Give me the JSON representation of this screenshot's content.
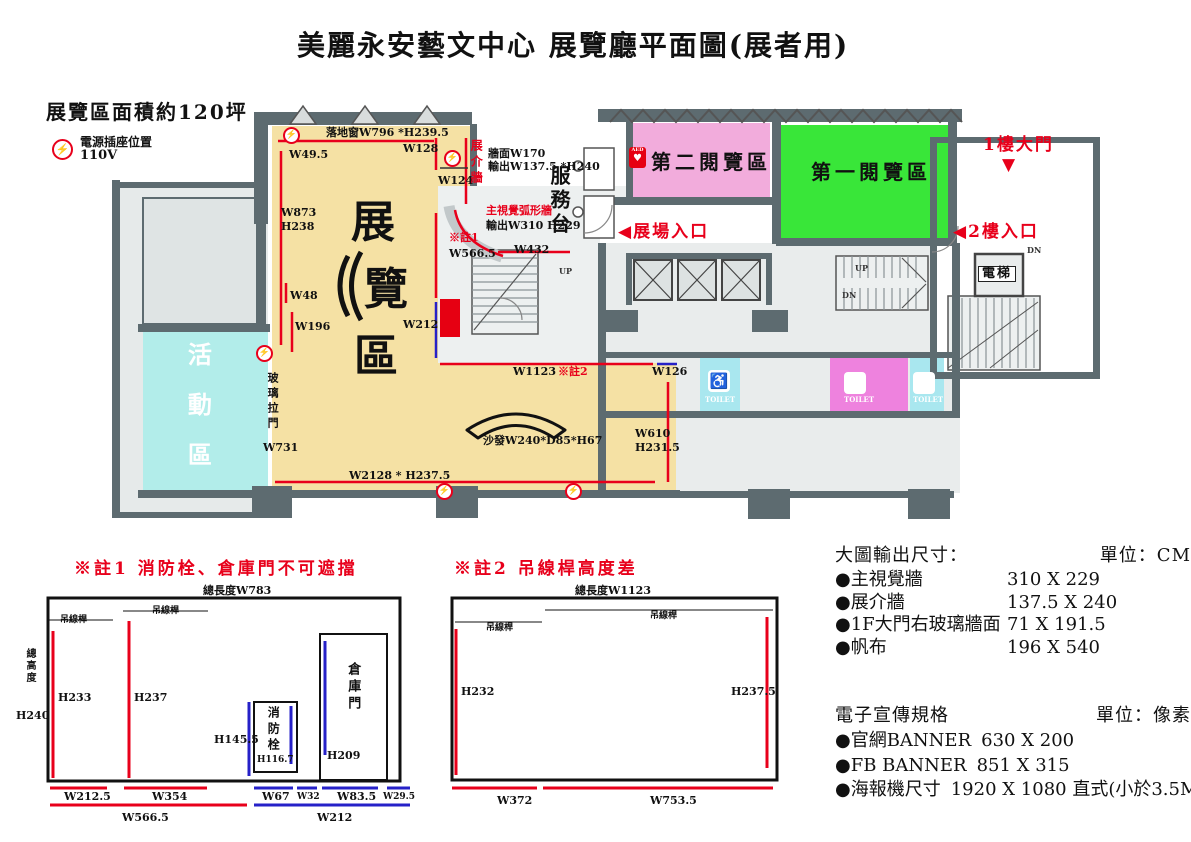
{
  "title": "美麗永安藝文中心 展覽廳平面圖(展者用)",
  "legend": {
    "area": "展覽區面積約120坪",
    "power_label": "電源插座位置",
    "power_voltage": "110V",
    "power_glyph": "⚡"
  },
  "icons": {
    "wheelchair": "♿",
    "aed_text": "AED",
    "aed_heart": "♥"
  },
  "colors": {
    "exhibition": "#F5E1A4",
    "activity": "#B2EDEA",
    "reading1": "#39E639",
    "reading2": "#F2ACDC",
    "toilet_cyan": "#A9E7EF",
    "toilet_pink": "#EE82DE",
    "wall": "#5D6B70",
    "annotation_red": "#E8001B",
    "annotation_blue": "#2621C8"
  },
  "power_icon_positions": [
    [
      283,
      127
    ],
    [
      444,
      150
    ],
    [
      256,
      345
    ],
    [
      436,
      483
    ],
    [
      565,
      483
    ]
  ],
  "labels": [
    {
      "n": "floor-window-measure",
      "t": "落地窗W796 *H239.5",
      "x": 326,
      "y": 127,
      "c": ""
    },
    {
      "n": "w49-5",
      "t": "W49.5",
      "x": 289,
      "y": 149,
      "c": ""
    },
    {
      "n": "w128",
      "t": "W128",
      "x": 403,
      "y": 143,
      "c": ""
    },
    {
      "n": "w124",
      "t": "W124",
      "x": 438,
      "y": 175,
      "c": ""
    },
    {
      "n": "w873",
      "t": "W873",
      "x": 281,
      "y": 207,
      "c": ""
    },
    {
      "n": "h238",
      "t": "H238",
      "x": 281,
      "y": 221,
      "c": ""
    },
    {
      "n": "note1-ref",
      "t": "※註1",
      "x": 449,
      "y": 232,
      "c": "red"
    },
    {
      "n": "w566-5",
      "t": "W566.5",
      "x": 449,
      "y": 248,
      "c": ""
    },
    {
      "n": "w48",
      "t": "W48",
      "x": 290,
      "y": 290,
      "c": ""
    },
    {
      "n": "w196",
      "t": "W196",
      "x": 295,
      "y": 321,
      "c": ""
    },
    {
      "n": "w212",
      "t": "W212",
      "x": 403,
      "y": 319,
      "c": ""
    },
    {
      "n": "wall-w170",
      "t": "牆面W170",
      "x": 488,
      "y": 148,
      "c": ""
    },
    {
      "n": "wall-output",
      "t": "輸出W137.5 *H240",
      "x": 488,
      "y": 161,
      "c": ""
    },
    {
      "n": "main-visual-wall",
      "t": "主視覺弧形牆",
      "x": 486,
      "y": 205,
      "c": "red"
    },
    {
      "n": "main-visual-output",
      "t": "輸出W310 H229",
      "x": 486,
      "y": 220,
      "c": ""
    },
    {
      "n": "w432",
      "t": "W432",
      "x": 514,
      "y": 244,
      "c": ""
    },
    {
      "n": "w1123",
      "t": "W1123",
      "x": 513,
      "y": 366,
      "c": ""
    },
    {
      "n": "note2-ref",
      "t": "※註2",
      "x": 558,
      "y": 366,
      "c": "red"
    },
    {
      "n": "w126",
      "t": "W126",
      "x": 652,
      "y": 366,
      "c": ""
    },
    {
      "n": "w610",
      "t": "W610",
      "x": 635,
      "y": 428,
      "c": ""
    },
    {
      "n": "h231-5",
      "t": "H231.5",
      "x": 635,
      "y": 442,
      "c": ""
    },
    {
      "n": "sofa-size",
      "t": "沙發W240*D85*H67",
      "x": 483,
      "y": 435,
      "c": ""
    },
    {
      "n": "w2128",
      "t": "W2128 * H237.5",
      "x": 349,
      "y": 470,
      "c": ""
    },
    {
      "n": "glass-door",
      "t": "玻璃拉門",
      "x": 266,
      "y": 372,
      "c": "vert"
    },
    {
      "n": "w731",
      "t": "W731",
      "x": 263,
      "y": 442,
      "c": ""
    },
    {
      "n": "exhibit-intro-wall",
      "t": "展介牆",
      "x": 469,
      "y": 139,
      "c": "vert red sm12"
    },
    {
      "n": "service-counter",
      "t": "服務台",
      "x": 548,
      "y": 165,
      "c": "vert room"
    },
    {
      "n": "reading-room-2",
      "t": "第二閱覽區",
      "x": 651,
      "y": 151,
      "c": "room"
    },
    {
      "n": "reading-room-1",
      "t": "第一閱覽區",
      "x": 811,
      "y": 161,
      "c": "room"
    },
    {
      "n": "exhibition-char-1",
      "t": "展",
      "x": 351,
      "y": 199,
      "c": "big"
    },
    {
      "n": "exhibition-char-2",
      "t": "覽",
      "x": 364,
      "y": 266,
      "c": "big"
    },
    {
      "n": "exhibition-char-3",
      "t": "區",
      "x": 354,
      "y": 333,
      "c": "big"
    },
    {
      "n": "activity-room",
      "t": "活動區",
      "x": 184,
      "y": 342,
      "c": "vert actv"
    },
    {
      "n": "entrance-1f",
      "t": "1樓大門",
      "x": 983,
      "y": 136,
      "c": "r16"
    },
    {
      "n": "entrance-1f-arrow",
      "t": "▼",
      "x": 1002,
      "y": 156,
      "c": "r16"
    },
    {
      "n": "entrance-2f",
      "t": "◀2樓入口",
      "x": 953,
      "y": 223,
      "c": "r16"
    },
    {
      "n": "hall-entrance",
      "t": "◀展場入口",
      "x": 618,
      "y": 223,
      "c": "r16"
    },
    {
      "n": "elevator-room",
      "t": "電梯",
      "x": 978,
      "y": 266,
      "c": "elev"
    },
    {
      "n": "up-1",
      "t": "UP",
      "x": 559,
      "y": 267,
      "c": "tiny"
    },
    {
      "n": "up-2",
      "t": "UP",
      "x": 855,
      "y": 264,
      "c": "tiny"
    },
    {
      "n": "dn-1",
      "t": "DN",
      "x": 842,
      "y": 291,
      "c": "tiny"
    },
    {
      "n": "dn-2",
      "t": "DN",
      "x": 1027,
      "y": 246,
      "c": "tiny"
    },
    {
      "n": "hydrant",
      "t": "消防栓",
      "x": 445,
      "y": 302,
      "c": "vert hyd"
    },
    {
      "n": "toilet-accessible-text",
      "t": "TOILET",
      "x": 705,
      "y": 396,
      "c": "toilet"
    },
    {
      "n": "toilet-women-text",
      "t": "TOILET",
      "x": 844,
      "y": 396,
      "c": "toilet"
    },
    {
      "n": "toilet-men-text",
      "t": "TOILET",
      "x": 913,
      "y": 396,
      "c": "toilet"
    },
    {
      "n": "note1-title",
      "t": "※註1 消防栓、倉庫門不可遮擋",
      "x": 74,
      "y": 560,
      "c": "note-title"
    },
    {
      "n": "note1-total-length",
      "t": "總長度W783",
      "x": 203,
      "y": 585,
      "c": ""
    },
    {
      "n": "note1-total-height",
      "t": "總高度",
      "x": 24,
      "y": 648,
      "c": "vert sm10"
    },
    {
      "n": "note1-h240",
      "t": "H240",
      "x": 16,
      "y": 710,
      "c": ""
    },
    {
      "n": "note1-bar-label-1",
      "t": "吊線桿",
      "x": 60,
      "y": 616,
      "c": "tinycjk"
    },
    {
      "n": "note1-bar-label-2",
      "t": "吊線桿",
      "x": 152,
      "y": 607,
      "c": "tinycjk"
    },
    {
      "n": "note1-h233",
      "t": "H233",
      "x": 58,
      "y": 692,
      "c": ""
    },
    {
      "n": "note1-h237",
      "t": "H237",
      "x": 134,
      "y": 692,
      "c": ""
    },
    {
      "n": "note1-h145-5",
      "t": "H145.5",
      "x": 214,
      "y": 734,
      "c": ""
    },
    {
      "n": "note1-hydrant",
      "t": "消防栓",
      "x": 266,
      "y": 706,
      "c": "vert sm12"
    },
    {
      "n": "note1-h116-7",
      "t": "H116.7",
      "x": 257,
      "y": 756,
      "c": "sm9"
    },
    {
      "n": "note1-warehouse",
      "t": "倉庫門",
      "x": 345,
      "y": 662,
      "c": "vert sm13"
    },
    {
      "n": "note1-h209",
      "t": "H209",
      "x": 327,
      "y": 750,
      "c": ""
    },
    {
      "n": "note1-w212-5",
      "t": "W212.5",
      "x": 64,
      "y": 791,
      "c": ""
    },
    {
      "n": "note1-w354",
      "t": "W354",
      "x": 152,
      "y": 791,
      "c": ""
    },
    {
      "n": "note1-w566-5",
      "t": "W566.5",
      "x": 122,
      "y": 812,
      "c": ""
    },
    {
      "n": "note1-w67",
      "t": "W67",
      "x": 262,
      "y": 791,
      "c": ""
    },
    {
      "n": "note1-w32",
      "t": "W32",
      "x": 297,
      "y": 793,
      "c": "sm9"
    },
    {
      "n": "note1-w83-5",
      "t": "W83.5",
      "x": 337,
      "y": 791,
      "c": ""
    },
    {
      "n": "note1-w29-5",
      "t": "W29.5",
      "x": 383,
      "y": 793,
      "c": "sm9"
    },
    {
      "n": "note1-w212",
      "t": "W212",
      "x": 317,
      "y": 812,
      "c": ""
    },
    {
      "n": "note2-title",
      "t": "※註2 吊線桿高度差",
      "x": 454,
      "y": 560,
      "c": "note-title"
    },
    {
      "n": "note2-total-length",
      "t": "總長度W1123",
      "x": 575,
      "y": 585,
      "c": ""
    },
    {
      "n": "note2-bar-label-1",
      "t": "吊線桿",
      "x": 486,
      "y": 624,
      "c": "tinycjk"
    },
    {
      "n": "note2-bar-label-2",
      "t": "吊線桿",
      "x": 650,
      "y": 612,
      "c": "tinycjk"
    },
    {
      "n": "note2-h232",
      "t": "H232",
      "x": 461,
      "y": 686,
      "c": ""
    },
    {
      "n": "note2-h237-5",
      "t": "H237.5",
      "x": 731,
      "y": 686,
      "c": ""
    },
    {
      "n": "note2-w372",
      "t": "W372",
      "x": 497,
      "y": 795,
      "c": ""
    },
    {
      "n": "note2-w753-5",
      "t": "W753.5",
      "x": 650,
      "y": 795,
      "c": ""
    }
  ],
  "output_specs": {
    "header": "大圖輸出尺寸：",
    "unit": "單位：CM",
    "items": [
      {
        "name": "●主視覺牆",
        "size": "310 X 229"
      },
      {
        "name": "●展介牆",
        "size": "137.5 X 240"
      },
      {
        "name": "●1F大門右玻璃牆面",
        "size": "71 X 191.5"
      },
      {
        "name": "●帆布",
        "size": "196 X 540"
      }
    ]
  },
  "digital_specs": {
    "header": "電子宣傳規格",
    "unit": "單位：像素",
    "items": [
      {
        "name": "●官網BANNER",
        "size": "630 X 200"
      },
      {
        "name": "●FB BANNER",
        "size": "851 X 315"
      },
      {
        "name": "●海報機尺寸",
        "size": "1920 X 1080 直式(小於3.5MB)"
      }
    ]
  }
}
